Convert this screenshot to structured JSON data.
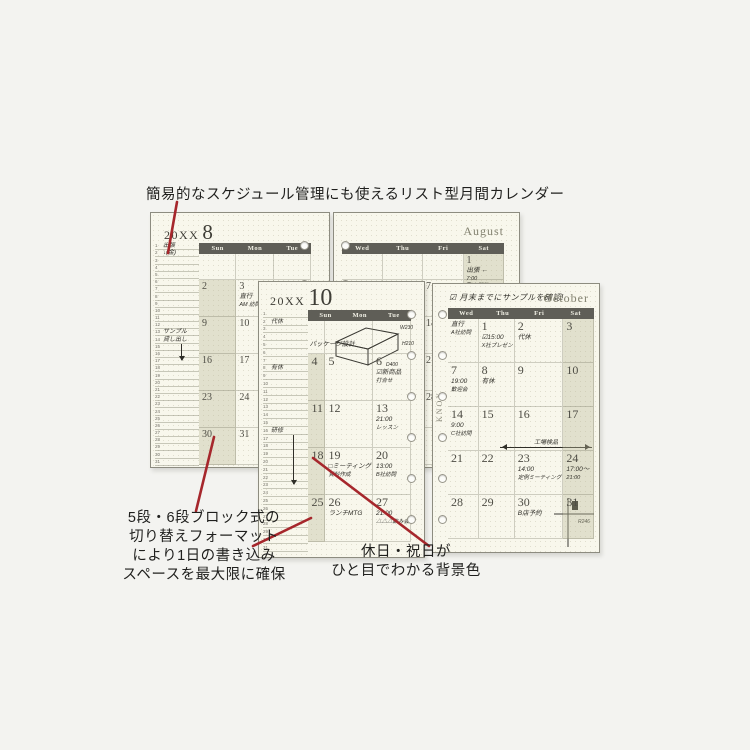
{
  "annotations": {
    "top": "簡易的なスケジュール管理にも使えるリスト型月間カレンダー",
    "bottom_left_lines": [
      "5段・6段ブロック式の",
      "切り替えフォーマット",
      "により1日の書き込み",
      "スペースを最大限に確保"
    ],
    "bottom_center_lines": [
      "休日・祝日が",
      "ひと目でわかる背景色"
    ]
  },
  "colors": {
    "canvas_bg": "#f3f3f0",
    "page_bg": "#f8f7ec",
    "day_header_bar": "#5f5e57",
    "holiday_cell": "#e4e3d2",
    "callout_line": "#a6272c",
    "handwriting_ink": "#2f2e28"
  },
  "pages": {
    "august_left": {
      "year": "20XX",
      "month": "8",
      "day_headers": [
        "Sun",
        "Mon",
        "Tue"
      ],
      "list": {
        "count": 31,
        "notes": [
          {
            "row": 1,
            "text": "出張"
          },
          {
            "row": 2,
            "text": "↓(金)"
          },
          {
            "row": 13,
            "text": "サンプル"
          },
          {
            "row": 14,
            "text": "貸し出し"
          }
        ],
        "arrow": {
          "from": 15,
          "to": 18
        }
      },
      "rows": [
        [
          {
            "d": ""
          },
          {
            "d": ""
          },
          {
            "d": ""
          }
        ],
        [
          {
            "d": "2",
            "h": true
          },
          {
            "d": "3",
            "notes": [
              "直行",
              "AM 訪問"
            ]
          },
          {
            "d": "4"
          }
        ],
        [
          {
            "d": "9",
            "h": true
          },
          {
            "d": "10"
          },
          {
            "d": "11"
          }
        ],
        [
          {
            "d": "16",
            "h": true
          },
          {
            "d": "17"
          },
          {
            "d": "18"
          }
        ],
        [
          {
            "d": "23",
            "h": true
          },
          {
            "d": "24"
          },
          {
            "d": "25"
          }
        ],
        [
          {
            "d": "30",
            "h": true
          },
          {
            "d": "31"
          },
          {
            "d": ""
          }
        ]
      ]
    },
    "august_right": {
      "month_name": "August",
      "day_headers": [
        "Wed",
        "Thu",
        "Fri",
        "Sat"
      ],
      "rows": [
        [
          {
            "d": ""
          },
          {
            "d": ""
          },
          {
            "d": ""
          },
          {
            "d": "1",
            "h": true,
            "notes": [
              "出張 ←",
              "7:00",
              "東京駅発"
            ]
          }
        ],
        [
          {
            "d": "5"
          },
          {
            "d": "6"
          },
          {
            "d": "7"
          },
          {
            "d": "8",
            "h": true
          }
        ],
        [
          {
            "d": "12"
          },
          {
            "d": "13"
          },
          {
            "d": "14"
          },
          {
            "d": "15",
            "h": true
          }
        ],
        [
          {
            "d": "19"
          },
          {
            "d": "20"
          },
          {
            "d": "21"
          },
          {
            "d": "22",
            "h": true
          }
        ],
        [
          {
            "d": "26"
          },
          {
            "d": "27"
          },
          {
            "d": "28"
          },
          {
            "d": "29",
            "h": true
          }
        ],
        [
          {
            "d": ""
          },
          {
            "d": ""
          },
          {
            "d": ""
          },
          {
            "d": ""
          }
        ]
      ]
    },
    "october_left": {
      "year": "20XX",
      "month": "10",
      "day_headers": [
        "Sun",
        "Mon",
        "Tue"
      ],
      "top_note": "パッケージ設計",
      "box_sketch": {
        "w": "W230",
        "h": "H210",
        "d": "D400"
      },
      "list": {
        "count": 31,
        "notes": [
          {
            "row": 2,
            "text": "代休"
          },
          {
            "row": 8,
            "text": "有休"
          },
          {
            "row": 16,
            "text": "研修"
          }
        ],
        "arrow": {
          "from": 17,
          "to": 24
        }
      },
      "rows": [
        [
          {
            "d": ""
          },
          {
            "d": ""
          },
          {
            "d": ""
          }
        ],
        [
          {
            "d": "4",
            "h": true
          },
          {
            "d": "5"
          },
          {
            "d": "6",
            "notes": [
              "☑新商品",
              "打合せ"
            ]
          }
        ],
        [
          {
            "d": "11",
            "h": true
          },
          {
            "d": "12"
          },
          {
            "d": "13",
            "notes": [
              "21:00",
              "レッスン"
            ]
          }
        ],
        [
          {
            "d": "18",
            "h": true
          },
          {
            "d": "19",
            "notes": [
              "□ミーティング",
              "資料作成"
            ]
          },
          {
            "d": "20",
            "notes": [
              "13:00",
              "B社訪問"
            ]
          }
        ],
        [
          {
            "d": "25",
            "h": true
          },
          {
            "d": "26",
            "notes": [
              "ランチMTG"
            ]
          },
          {
            "d": "27",
            "notes": [
              "21:00",
              "△△△飲み会"
            ]
          }
        ]
      ]
    },
    "october_right": {
      "month_name": "October",
      "header_note": "☑ 月末までにサンプルを確認!",
      "brand": "KNOX",
      "day_headers": [
        "Wed",
        "Thu",
        "Fri",
        "Sat"
      ],
      "span_label": "工場検品",
      "map_label": "R246",
      "rows": [
        [
          {
            "d": "",
            "notes": [
              "直行",
              "A社訪問"
            ]
          },
          {
            "d": "1",
            "notes": [
              "☑15:00",
              "X社プレゼン"
            ]
          },
          {
            "d": "2",
            "notes": [
              "代休"
            ]
          },
          {
            "d": "3",
            "h": true
          }
        ],
        [
          {
            "d": "7",
            "notes": [
              "19:00",
              "歓迎会"
            ]
          },
          {
            "d": "8",
            "notes": [
              "有休"
            ]
          },
          {
            "d": "9"
          },
          {
            "d": "10",
            "h": true
          }
        ],
        [
          {
            "d": "14",
            "notes": [
              "9:00",
              "C社訪問"
            ]
          },
          {
            "d": "15"
          },
          {
            "d": "16"
          },
          {
            "d": "17",
            "h": true
          }
        ],
        [
          {
            "d": "21"
          },
          {
            "d": "22"
          },
          {
            "d": "23",
            "notes": [
              "14:00",
              "定例ミーティング"
            ]
          },
          {
            "d": "24",
            "h": true,
            "notes": [
              "17:00〜",
              "21:00"
            ]
          }
        ],
        [
          {
            "d": "28"
          },
          {
            "d": "29"
          },
          {
            "d": "30",
            "notes": [
              "B店予約"
            ]
          },
          {
            "d": "31",
            "h": true
          }
        ]
      ]
    }
  }
}
